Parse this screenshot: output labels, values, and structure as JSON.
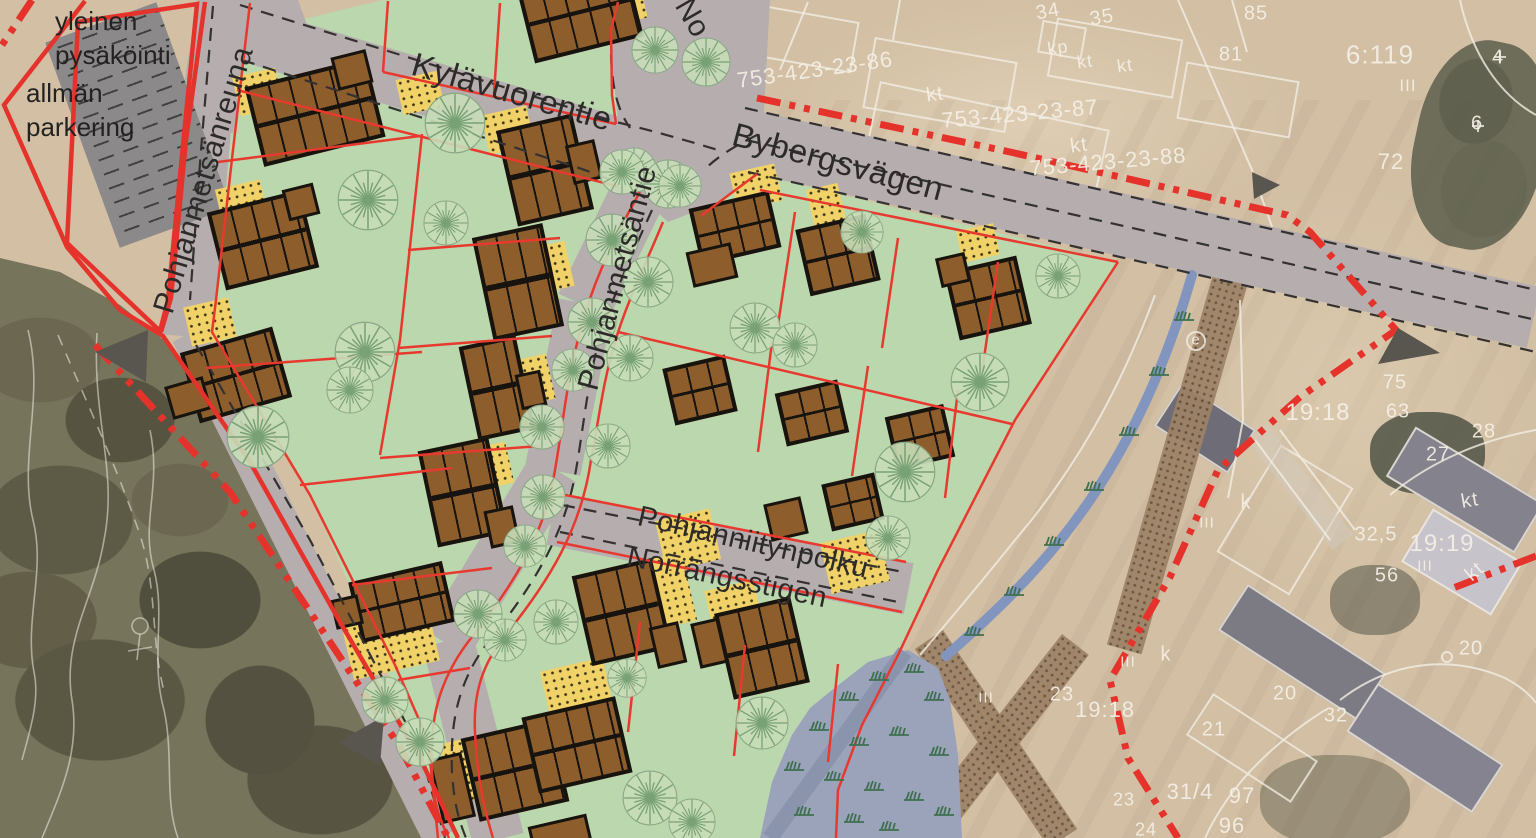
{
  "map": {
    "type": "detail-plan-on-aerial-photo",
    "parking": {
      "fi": "yleinen pysäköinti",
      "sv": "allmän parkering"
    },
    "streets": {
      "kylavuorentie": "Kylävuorentie",
      "bybergsvagen": "Bybergsvägen",
      "pohjanmetsantie": "Pohjanmetsäntie",
      "pohjanmetsanreuna": "Pohjanmetsänreuna",
      "pohjanniitynpolku": "Pohjanniitynpolku",
      "norrangsstigen": "Norrängsstigen",
      "partial_top": "No"
    },
    "cadastral_labels": [
      {
        "t": "34",
        "x": 1048,
        "y": 12,
        "s": 20,
        "r": -10
      },
      {
        "t": "35",
        "x": 1102,
        "y": 18,
        "s": 20,
        "r": -10
      },
      {
        "t": "85",
        "x": 1256,
        "y": 14,
        "s": 20,
        "r": 0
      },
      {
        "t": "81",
        "x": 1231,
        "y": 55,
        "s": 20,
        "r": 0
      },
      {
        "t": "753-423-23-86",
        "x": 815,
        "y": 70,
        "s": 22,
        "r": -8
      },
      {
        "t": "753-423-23-87",
        "x": 1020,
        "y": 114,
        "s": 22,
        "r": -5
      },
      {
        "t": "753-423-23-88",
        "x": 1108,
        "y": 162,
        "s": 22,
        "r": -5
      },
      {
        "t": "kt",
        "x": 935,
        "y": 95,
        "s": 20,
        "r": -8
      },
      {
        "t": "kp",
        "x": 1058,
        "y": 48,
        "s": 18,
        "r": -8
      },
      {
        "t": "kt",
        "x": 1085,
        "y": 62,
        "s": 18,
        "r": -8
      },
      {
        "t": "kt",
        "x": 1125,
        "y": 66,
        "s": 18,
        "r": -8
      },
      {
        "t": "kt",
        "x": 1079,
        "y": 146,
        "s": 20,
        "r": -8
      },
      {
        "t": "6:119",
        "x": 1380,
        "y": 55,
        "s": 26,
        "r": 0
      },
      {
        "t": "III",
        "x": 1408,
        "y": 86,
        "s": 17,
        "r": 0
      },
      {
        "t": "4",
        "x": 1498,
        "y": 58,
        "s": 20,
        "r": 0
      },
      {
        "t": "6",
        "x": 1477,
        "y": 124,
        "s": 20,
        "r": 0
      },
      {
        "t": "72",
        "x": 1391,
        "y": 162,
        "s": 22,
        "r": 0
      },
      {
        "t": "e",
        "x": 1196,
        "y": 340,
        "s": 15,
        "r": 0
      },
      {
        "t": "75",
        "x": 1395,
        "y": 383,
        "s": 20,
        "r": 0
      },
      {
        "t": "63",
        "x": 1398,
        "y": 412,
        "s": 20,
        "r": 0
      },
      {
        "t": "19:18",
        "x": 1318,
        "y": 413,
        "s": 24,
        "r": 0
      },
      {
        "t": "28",
        "x": 1484,
        "y": 432,
        "s": 20,
        "r": 0
      },
      {
        "t": "27",
        "x": 1438,
        "y": 455,
        "s": 20,
        "r": 0
      },
      {
        "t": "kt",
        "x": 1470,
        "y": 501,
        "s": 20,
        "r": -10
      },
      {
        "t": "k",
        "x": 1246,
        "y": 503,
        "s": 20,
        "r": 0
      },
      {
        "t": "III",
        "x": 1207,
        "y": 523,
        "s": 15,
        "r": 0
      },
      {
        "t": "32,5",
        "x": 1376,
        "y": 535,
        "s": 20,
        "r": 0
      },
      {
        "t": "19:19",
        "x": 1442,
        "y": 544,
        "s": 24,
        "r": 0
      },
      {
        "t": "III",
        "x": 1425,
        "y": 566,
        "s": 15,
        "r": 0
      },
      {
        "t": "56",
        "x": 1387,
        "y": 576,
        "s": 20,
        "r": 0
      },
      {
        "t": "kt",
        "x": 1475,
        "y": 572,
        "s": 20,
        "r": -40
      },
      {
        "t": "20",
        "x": 1471,
        "y": 649,
        "s": 20,
        "r": 0
      },
      {
        "t": "23",
        "x": 1062,
        "y": 695,
        "s": 20,
        "r": 0
      },
      {
        "t": "19:18",
        "x": 1105,
        "y": 710,
        "s": 22,
        "r": 0
      },
      {
        "t": "III",
        "x": 1128,
        "y": 662,
        "s": 15,
        "r": 0
      },
      {
        "t": "k",
        "x": 1166,
        "y": 655,
        "s": 20,
        "r": 0
      },
      {
        "t": "20",
        "x": 1285,
        "y": 694,
        "s": 20,
        "r": 0
      },
      {
        "t": "32",
        "x": 1336,
        "y": 716,
        "s": 20,
        "r": 0
      },
      {
        "t": "21",
        "x": 1214,
        "y": 730,
        "s": 20,
        "r": 0
      },
      {
        "t": "31/4",
        "x": 1190,
        "y": 792,
        "s": 22,
        "r": 0
      },
      {
        "t": "97",
        "x": 1242,
        "y": 796,
        "s": 22,
        "r": 0
      },
      {
        "t": "96",
        "x": 1232,
        "y": 826,
        "s": 22,
        "r": 0
      },
      {
        "t": "23",
        "x": 1124,
        "y": 800,
        "s": 18,
        "r": 0
      },
      {
        "t": "24",
        "x": 1146,
        "y": 830,
        "s": 18,
        "r": 0
      },
      {
        "t": "III",
        "x": 986,
        "y": 698,
        "s": 15,
        "r": 0
      }
    ],
    "colors": {
      "boundary_red": "#e5332c",
      "lot_line_red": "#e8392f",
      "lot_green": "#bad7ae",
      "road_gray": "#b5adae",
      "building_brown": "#8d5e2c",
      "yard_yellow": "#f1d269",
      "wetland_blue": "#9ba3ba",
      "parking_gray": "#8c898a",
      "path_brown": "#9d8266",
      "aerial_tan": "#d2bfa4",
      "cadastral_white": "#f2ede1"
    }
  }
}
